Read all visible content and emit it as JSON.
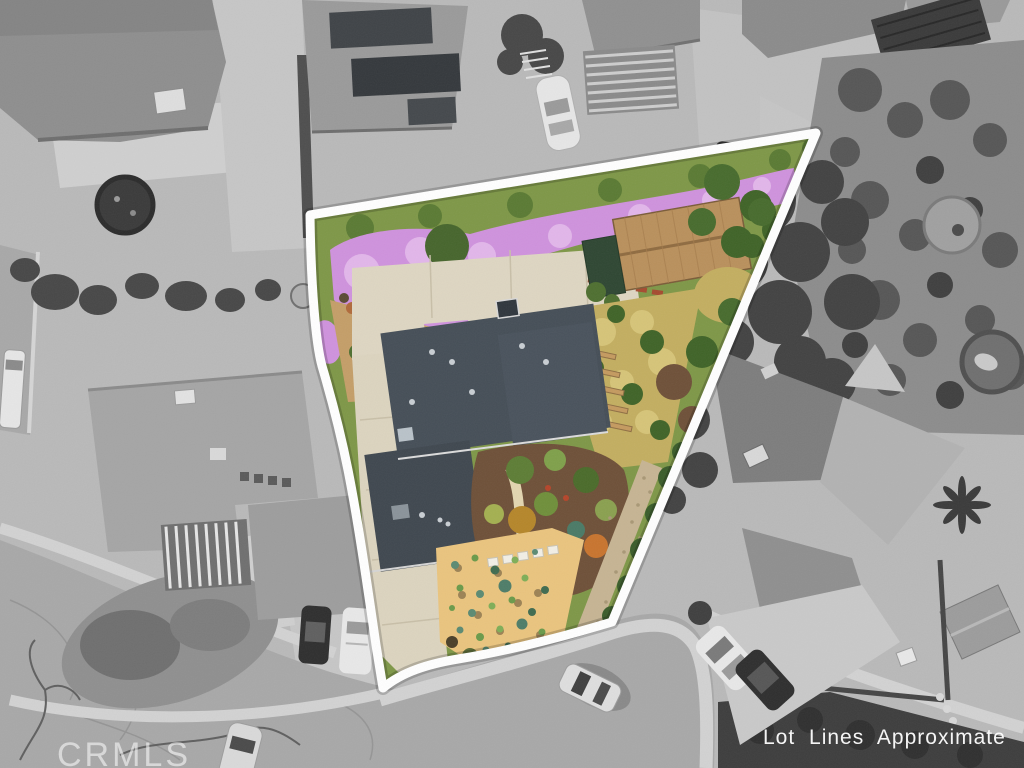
{
  "overlay": {
    "watermark": "CRMLS",
    "disclaimer": "Lot Lines Approximate"
  },
  "palette": {
    "lot_line": "#ffffff",
    "gray_base": "#b9b9b9",
    "street": "#a8a8a8",
    "sidewalk": "#d2d2d2",
    "gray_roof": "#8e8e8e",
    "gray_roof_light": "#b2b2b2",
    "solar_panel": "#3f4347",
    "tree_gray": "#474747",
    "tree_dark": "#3a3a3a",
    "grass_gray": "#8f8f8f",
    "flowers": "#cf92dd",
    "flowers_light": "#e2b6ea",
    "lawn": "#7e9747",
    "hedge": "#55702f",
    "house_roof": "#454e57",
    "house_roof_dark": "#3f474f",
    "shed_roof": "#b9905c",
    "shed_annex": "#2e4632",
    "concrete": "#ded6c2",
    "sand": "#eac47e",
    "gravel": "#c6b493",
    "mulch": "#6e5038",
    "dry_grass": "#c3ae60",
    "cactus": "#5b8a72",
    "car_white": "#e8e8e8",
    "car_dark": "#2e2e2e"
  }
}
